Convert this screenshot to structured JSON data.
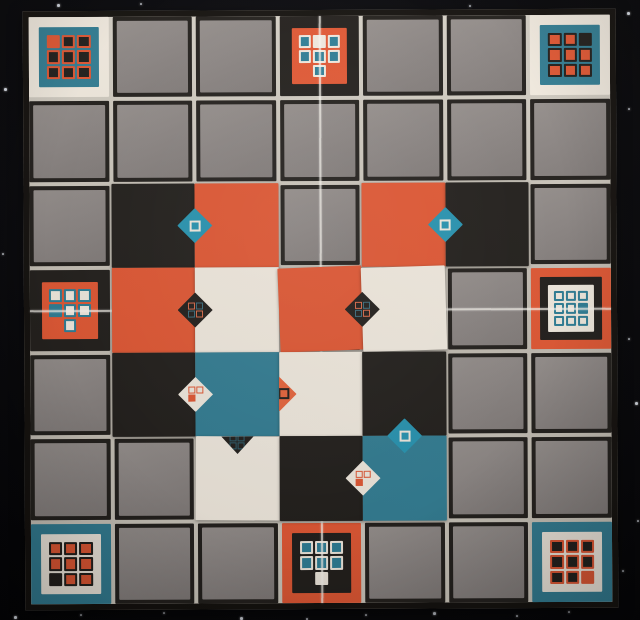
{
  "scene": {
    "description": "Photograph of a square abstract-strategy game board on a black starfield mat: 7x7 grid of gray cells, eight printed pattern tiles at corners and edge midpoints, fifteen colored square tiles placed in the center with diamond emblems on their seams",
    "colors": {
      "orange": "#e25834",
      "orange_bright": "#e8653c",
      "teal": "#337e94",
      "teal_grid": "#2e7e96",
      "diamond_teal": "#2895b2",
      "cream": "#f2ebe0",
      "black_tile": "#221f1c",
      "gray_cell": "#8d8785",
      "gutter": "#c9c3b9",
      "board_edge": "#14110e",
      "background": "#07070b",
      "star": "#e6ebf4",
      "fold_line": "#faf7f0"
    }
  },
  "board": {
    "rows": 7,
    "cols": 7,
    "cell_shape": "square",
    "base_cell_fill": "gray_cell",
    "base_cell_border": "black_tile"
  },
  "special_tiles": [
    {
      "id": "top-left-corner",
      "row": 0,
      "col": 0,
      "frames": [
        "cream",
        "teal"
      ],
      "frame_pads": [
        10,
        8
      ],
      "cell_fill": "black_tile",
      "cell_border": "orange",
      "highlight_fill": "orange",
      "pattern": [
        [
          "H",
          "C",
          "C"
        ],
        [
          "C",
          "C",
          "C"
        ],
        [
          "C",
          "C",
          "C"
        ]
      ]
    },
    {
      "id": "top-center",
      "row": 0,
      "col": 3,
      "frames": [
        "black_tile",
        "orange"
      ],
      "frame_pads": [
        12,
        7
      ],
      "cell_fill": "teal_grid",
      "cell_border": "cream",
      "highlight_fill": "cream",
      "pattern": [
        [
          "C",
          "H",
          "C"
        ],
        [
          "C",
          "C",
          "C"
        ],
        [
          ".",
          "C",
          "."
        ]
      ]
    },
    {
      "id": "top-right-corner",
      "row": 0,
      "col": 6,
      "frames": [
        "cream",
        "teal"
      ],
      "frame_pads": [
        10,
        8
      ],
      "cell_fill": "orange",
      "cell_border": "black_tile",
      "highlight_fill": "black_tile",
      "pattern": [
        [
          "C",
          "C",
          "H"
        ],
        [
          "C",
          "C",
          "C"
        ],
        [
          "C",
          "C",
          "C"
        ]
      ]
    },
    {
      "id": "middle-left",
      "row": 3,
      "col": 0,
      "frames": [
        "black_tile",
        "orange"
      ],
      "frame_pads": [
        12,
        7
      ],
      "cell_fill": "cream",
      "cell_border": "teal_grid",
      "highlight_fill": "teal_grid",
      "pattern": [
        [
          "C",
          "C",
          "C"
        ],
        [
          "H",
          "C",
          "C"
        ],
        [
          ".",
          "C",
          "."
        ]
      ]
    },
    {
      "id": "middle-right",
      "row": 3,
      "col": 6,
      "frames": [
        "orange",
        "black_tile",
        "cream"
      ],
      "frame_pads": [
        9,
        8,
        6
      ],
      "cell_fill": "cream",
      "cell_border": "teal_grid",
      "highlight_fill": "teal_grid",
      "pattern": [
        [
          "C",
          "C",
          "C"
        ],
        [
          "C",
          "C",
          "H"
        ],
        [
          "C",
          "C",
          "C"
        ]
      ]
    },
    {
      "id": "bottom-left-corner",
      "row": 6,
      "col": 0,
      "frames": [
        "teal",
        "cream"
      ],
      "frame_pads": [
        10,
        8
      ],
      "cell_fill": "orange",
      "cell_border": "black_tile",
      "highlight_fill": "black_tile",
      "pattern": [
        [
          "C",
          "C",
          "C"
        ],
        [
          "C",
          "C",
          "C"
        ],
        [
          "H",
          "C",
          "C"
        ]
      ]
    },
    {
      "id": "bottom-center",
      "row": 6,
      "col": 3,
      "frames": [
        "orange",
        "black_tile"
      ],
      "frame_pads": [
        10,
        8
      ],
      "cell_fill": "teal_grid",
      "cell_border": "cream",
      "highlight_fill": "cream",
      "pattern": [
        [
          "C",
          "C",
          "C"
        ],
        [
          "C",
          "C",
          "C"
        ],
        [
          ".",
          "H",
          "."
        ]
      ]
    },
    {
      "id": "bottom-right-corner",
      "row": 6,
      "col": 6,
      "frames": [
        "teal",
        "cream"
      ],
      "frame_pads": [
        10,
        8
      ],
      "cell_fill": "black_tile",
      "cell_border": "orange",
      "highlight_fill": "orange",
      "pattern": [
        [
          "C",
          "C",
          "C"
        ],
        [
          "C",
          "C",
          "C"
        ],
        [
          "C",
          "C",
          "H"
        ]
      ]
    }
  ],
  "placed_tiles": [
    {
      "row": 2,
      "col": 1,
      "color": "black_tile",
      "tilt": 0
    },
    {
      "row": 2,
      "col": 2,
      "color": "orange",
      "tilt": 0
    },
    {
      "row": 2,
      "col": 4,
      "color": "orange",
      "tilt": 0
    },
    {
      "row": 2,
      "col": 5,
      "color": "black_tile",
      "tilt": 0
    },
    {
      "row": 3,
      "col": 1,
      "color": "orange",
      "tilt": 0
    },
    {
      "row": 3,
      "col": 2,
      "color": "cream",
      "tilt": 0
    },
    {
      "row": 3,
      "col": 3,
      "color": "orange",
      "tilt": -2
    },
    {
      "row": 3,
      "col": 4,
      "color": "cream",
      "tilt": -1.5
    },
    {
      "row": 4,
      "col": 1,
      "color": "black_tile",
      "tilt": 0
    },
    {
      "row": 4,
      "col": 2,
      "color": "teal",
      "tilt": 0
    },
    {
      "row": 4,
      "col": 3,
      "color": "cream",
      "tilt": 0
    },
    {
      "row": 4,
      "col": 4,
      "color": "black_tile",
      "tilt": 0
    },
    {
      "row": 5,
      "col": 2,
      "color": "cream",
      "tilt": 0.5
    },
    {
      "row": 5,
      "col": 3,
      "color": "black_tile",
      "tilt": 0
    },
    {
      "row": 5,
      "col": 4,
      "color": "teal",
      "tilt": 0
    }
  ],
  "diamonds": [
    {
      "id": "d1",
      "seam": "v",
      "row": 2,
      "col": 1,
      "color": "diamond_teal",
      "glyph": "square-outline",
      "glyph_color": "cream",
      "visible": "full"
    },
    {
      "id": "d2",
      "seam": "v",
      "row": 2,
      "col": 4,
      "color": "diamond_teal",
      "glyph": "square-outline",
      "glyph_color": "cream",
      "visible": "full"
    },
    {
      "id": "d3",
      "seam": "v",
      "row": 3,
      "col": 1,
      "color": "black_tile",
      "glyph": "mini-grid",
      "glyph_color": "orange",
      "visible": "full"
    },
    {
      "id": "d4",
      "seam": "v",
      "row": 3,
      "col": 3,
      "color": "black_tile",
      "glyph": "mini-grid",
      "glyph_color": "orange",
      "visible": "full"
    },
    {
      "id": "d5",
      "seam": "v",
      "row": 4,
      "col": 1,
      "color": "cream",
      "glyph": "tromino",
      "glyph_color": "orange",
      "visible": "full"
    },
    {
      "id": "d6",
      "seam": "v",
      "row": 4,
      "col": 2,
      "color": "orange_bright",
      "glyph": "square-outline",
      "glyph_color": "black_tile",
      "visible": "right-half"
    },
    {
      "id": "d7",
      "seam": "h",
      "row": 4,
      "col": 2,
      "color": "black_tile",
      "glyph": "mini-grid",
      "glyph_color": "teal",
      "visible": "bottom-half"
    },
    {
      "id": "d8",
      "seam": "h",
      "row": 4,
      "col": 4,
      "color": "diamond_teal",
      "glyph": "square-outline",
      "glyph_color": "cream",
      "visible": "full"
    },
    {
      "id": "d9",
      "seam": "v",
      "row": 5,
      "col": 3,
      "color": "cream",
      "glyph": "tromino",
      "glyph_color": "orange",
      "visible": "full"
    }
  ],
  "fold_lines": {
    "vertical_at_col": 3,
    "horizontal_at_row": 3
  },
  "background": {
    "stars": [
      [
        57,
        4
      ],
      [
        140,
        3
      ],
      [
        469,
        5
      ],
      [
        627,
        12
      ],
      [
        628,
        108
      ],
      [
        535,
        99
      ],
      [
        541,
        127
      ],
      [
        594,
        209
      ],
      [
        603,
        212
      ],
      [
        4,
        88
      ],
      [
        2,
        253
      ],
      [
        628,
        338
      ],
      [
        635,
        402
      ],
      [
        637,
        520
      ],
      [
        622,
        570
      ],
      [
        14,
        616
      ],
      [
        80,
        614
      ],
      [
        163,
        612
      ],
      [
        240,
        617
      ],
      [
        306,
        618
      ],
      [
        365,
        614
      ],
      [
        433,
        612
      ],
      [
        516,
        615
      ],
      [
        568,
        611
      ],
      [
        605,
        601
      ]
    ]
  }
}
